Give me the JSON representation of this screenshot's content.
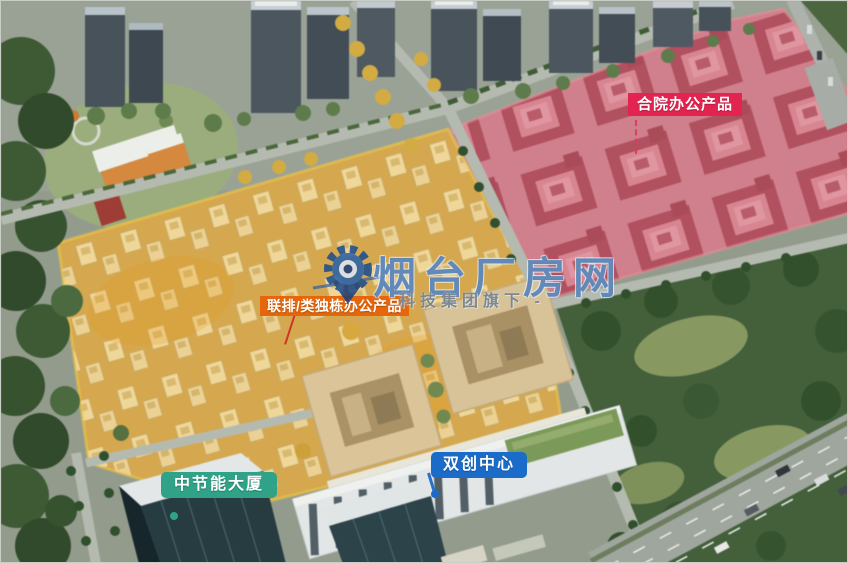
{
  "labels": {
    "courtyard": {
      "text": "合院办公产品",
      "bg": "#E32450"
    },
    "townhouse": {
      "text": "联排/类独栋办公产品",
      "bg": "#E5660B"
    },
    "cecep": {
      "text": "中节能大厦",
      "bg": "#2FA287"
    },
    "innovation": {
      "text": "双创中心",
      "bg": "#1B6CC8"
    }
  },
  "watermark": {
    "brand": "烟台厂房网",
    "suffix": "科技集团旗下 -",
    "color": "#2D5F9E",
    "logo": "gear-location-pin-icon"
  },
  "zone_colors": {
    "courtyard_overlay": "#E07080",
    "townhouse_overlay": "#F3B41F"
  }
}
